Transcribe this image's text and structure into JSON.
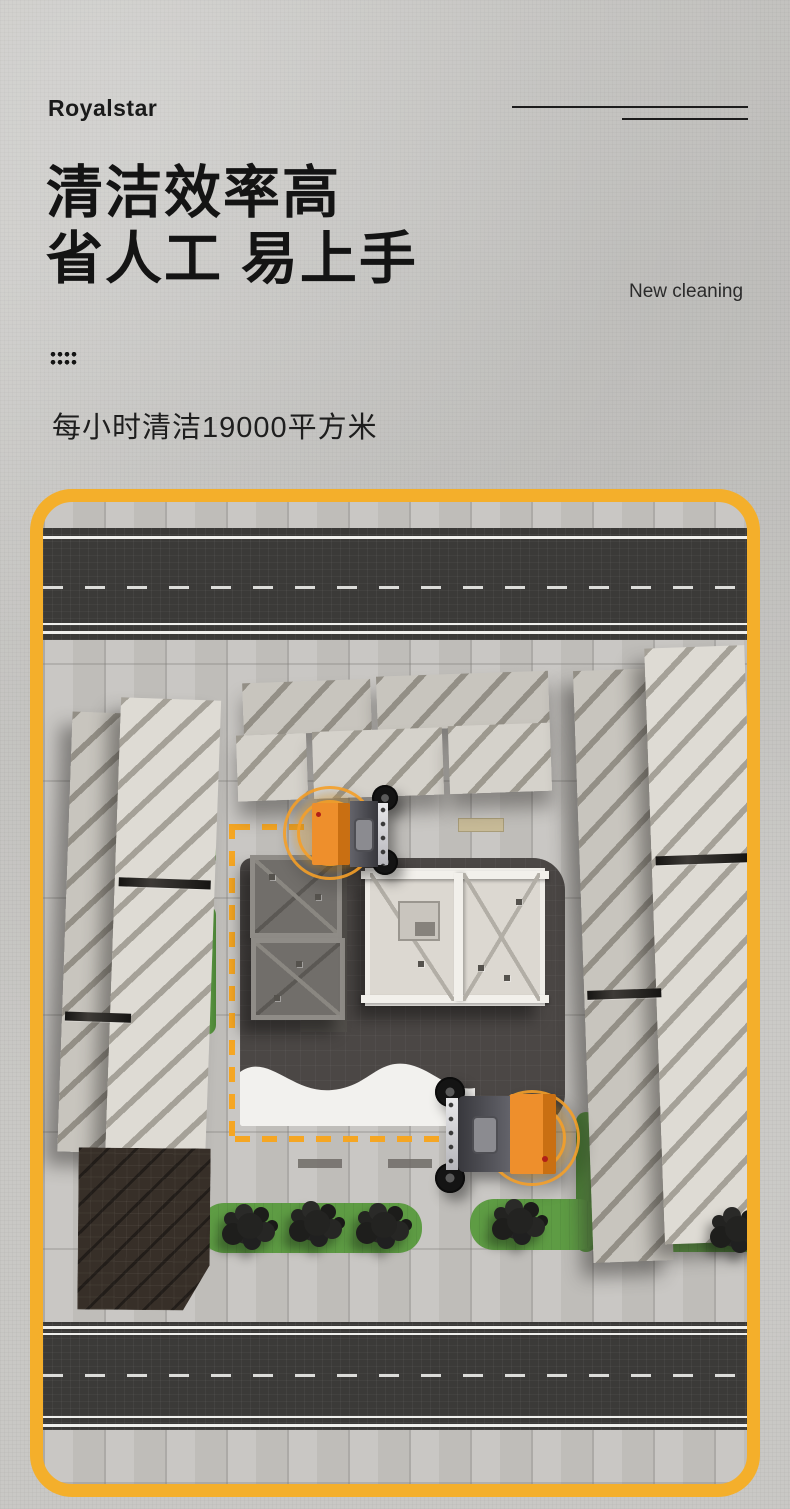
{
  "header": {
    "brand": "Royalstar",
    "title_line1": "清洁效率高",
    "title_line2": "省人工 易上手",
    "tagline": "New cleaning",
    "subtitle": "每小时清洁19000平方米"
  },
  "colors": {
    "page_background": "#C9C8C5",
    "accent_border": "#F4AF2B",
    "route_dash": "#F5A623",
    "vehicle_orange": "#EE8F2C",
    "grass_green": "#5E9C44",
    "asphalt": "#3B3A38",
    "plaza_dark": "#4B4745",
    "text_dark": "#141414"
  },
  "scene": {
    "icons": [
      "grid-dots-icon"
    ],
    "vehicles": [
      "sweeper-vehicle-top",
      "sweeper-vehicle-bottom"
    ],
    "route": "dashed-cleaning-route"
  }
}
